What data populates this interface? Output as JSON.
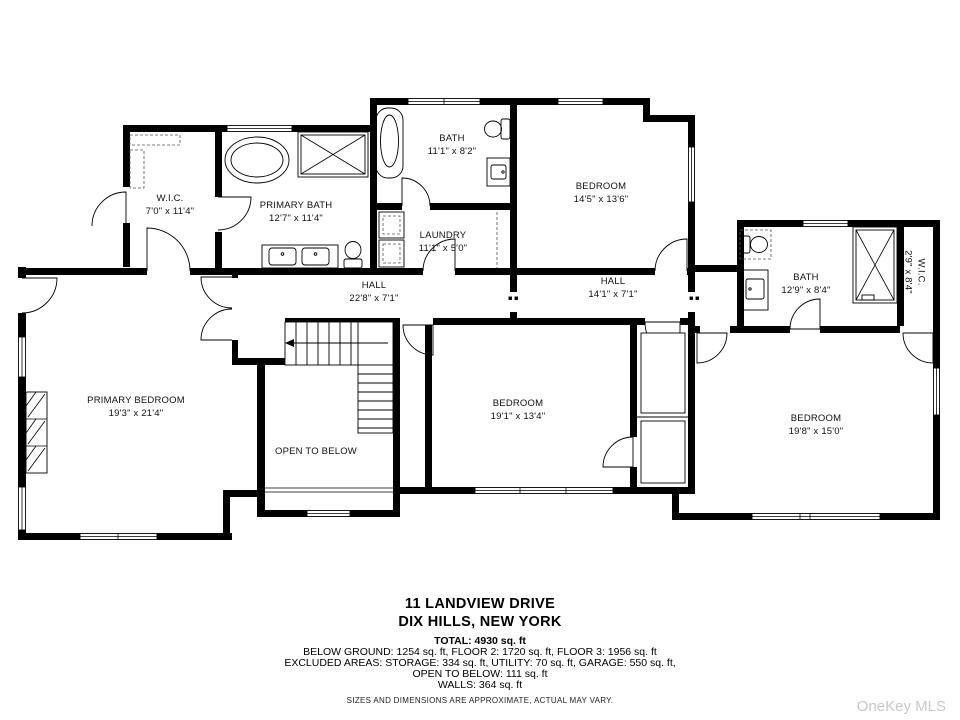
{
  "rooms": {
    "wic_left": {
      "name": "W.I.C.",
      "dims": "7'0\" x 11'4\""
    },
    "primary_bath": {
      "name": "PRIMARY BATH",
      "dims": "12'7\" x 11'4\""
    },
    "bath_top": {
      "name": "BATH",
      "dims": "11'1\" x 8'2\""
    },
    "laundry": {
      "name": "LAUNDRY",
      "dims": "11'1\" x 5'0\""
    },
    "bedroom_top": {
      "name": "BEDROOM",
      "dims": "14'5\" x 13'6\""
    },
    "hall_main": {
      "name": "HALL",
      "dims": "22'8\" x 7'1\""
    },
    "hall_east": {
      "name": "HALL",
      "dims": "14'1\" x 7'1\""
    },
    "bath_right": {
      "name": "BATH",
      "dims": "12'9\" x 8'4\""
    },
    "wic_right": {
      "name": "W.I.C.",
      "dims": "2'9\" x 8'4\""
    },
    "primary_bedroom": {
      "name": "PRIMARY BEDROOM",
      "dims": "19'3\" x 21'4\""
    },
    "bedroom_mid": {
      "name": "BEDROOM",
      "dims": "19'1\" x 13'4\""
    },
    "open_below": {
      "name": "OPEN TO BELOW"
    },
    "bedroom_right": {
      "name": "BEDROOM",
      "dims": "19'8\" x 15'0\""
    }
  },
  "footer": {
    "address_line1": "11 LANDVIEW DRIVE",
    "address_line2": "DIX HILLS, NEW YORK",
    "total": "TOTAL: 4930 sq. ft",
    "floors": "BELOW GROUND: 1254 sq. ft, FLOOR 2: 1720 sq. ft, FLOOR 3: 1956 sq. ft",
    "excluded": "EXCLUDED AREAS: STORAGE: 334 sq. ft, UTILITY: 70 sq. ft, GARAGE: 550 sq. ft,",
    "open_below": "OPEN TO BELOW: 111 sq. ft",
    "walls": "WALLS: 364 sq. ft",
    "disclaimer": "SIZES AND DIMENSIONS ARE APPROXIMATE, ACTUAL MAY VARY.",
    "watermark": "OneKey MLS"
  }
}
